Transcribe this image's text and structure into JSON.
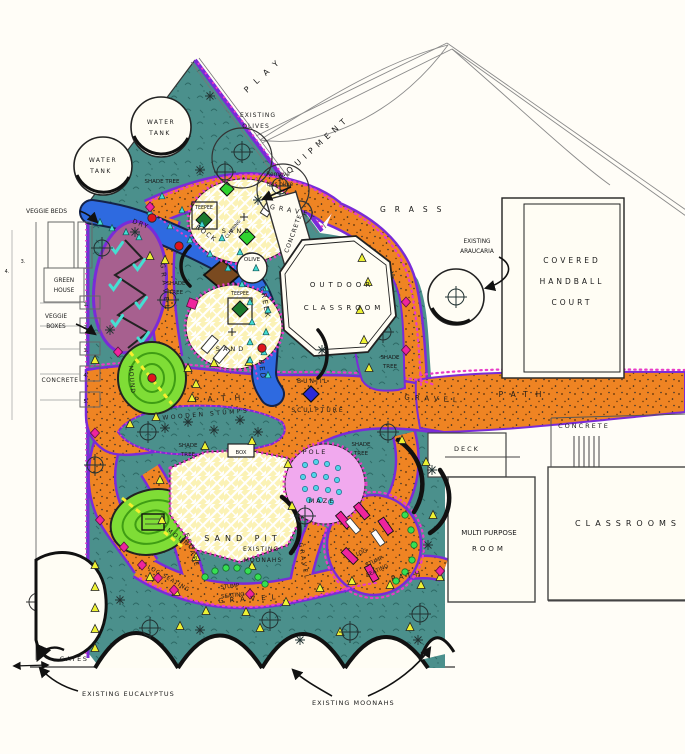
{
  "labels": {
    "play": "PLAY",
    "equipment": "EQUIPMENT",
    "grass": "GRASS",
    "water_tank": {
      "l1": "WATER",
      "l2": "TANK"
    },
    "existing_olives": {
      "l1": "EXISTING",
      "l2": "OLIVES"
    },
    "remove_olive": {
      "l1": "Remove",
      "l2": "this olive"
    },
    "shade_tree_inline": "SHADE TREE",
    "shade_tree": {
      "l1": "SHADE",
      "l2": "TREE"
    },
    "veggie_beds": "VEGGIE BEDS",
    "green_house": {
      "l1": "GREEN",
      "l2": "HOUSE"
    },
    "veggie_boxes": {
      "l1": "VEGGIE",
      "l2": "BOXES"
    },
    "concrete": "CONCRETE",
    "bed_numbers": [
      "1.",
      "2.",
      "3.",
      "4.",
      "5."
    ],
    "gravel": "GRAVEL",
    "path": "PATH",
    "dry": "DRY",
    "rock": "ROCK",
    "creek": "CREEK",
    "bed": "BED",
    "sand": "SAND",
    "teepee": "TEEPEE",
    "climbing": "CLIMBING",
    "olive": "OLIVE",
    "outdoor_classroom": {
      "l1": "OUTDOOR",
      "l2": "CLASSROOM"
    },
    "bunjil_sculpture": {
      "l1": "BUNJIL",
      "l2": "SCULPTURE"
    },
    "existing_araucaria": {
      "l1": "EXISTING",
      "l2": "ARAUCARIA"
    },
    "covered_handball_court": {
      "l1": "COVERED",
      "l2": "HANDBALL",
      "l3": "COURT"
    },
    "deck": "DECK",
    "classrooms": "CLASSROOMS",
    "multi_purpose_room": {
      "l1": "MULTI PURPOSE",
      "l2": "ROOM"
    },
    "wooden_stumps": "WOODEN STUMPS",
    "box": "BOX",
    "sand_pit": "SAND PIT",
    "pole": "POLE",
    "maze": "MAZE",
    "mound": "MOUND",
    "escape": "ESCAPE",
    "log": "LOG",
    "log_seating": "LOG SEATING",
    "stump_seating": {
      "l1": "STUMP",
      "l2": "SEATING"
    },
    "existing_moonahs": {
      "l1": "EXISTING",
      "l2": "MOONAHS"
    },
    "existing_moonahs_inline": "EXISTING MOONAHS",
    "gates": "GATES",
    "existing_eucalyptus": "EXISTING EUCALYPTUS"
  },
  "colors": {
    "teal_planting": "#4b908c",
    "path_orange": "#ef8423",
    "boundary_purple": "#7a2bd8",
    "dotted_magenta": "#e83cc8",
    "creek_blue": "#2e6ae0",
    "sand_yellow": "#fbf2b6",
    "maze_pink": "#f1a9ee",
    "mound_green": "#7fdd36",
    "balance_mauve": "#a7608f",
    "marker_magenta": "#ee249e",
    "bunjil_blue": "#2a2ad8"
  }
}
